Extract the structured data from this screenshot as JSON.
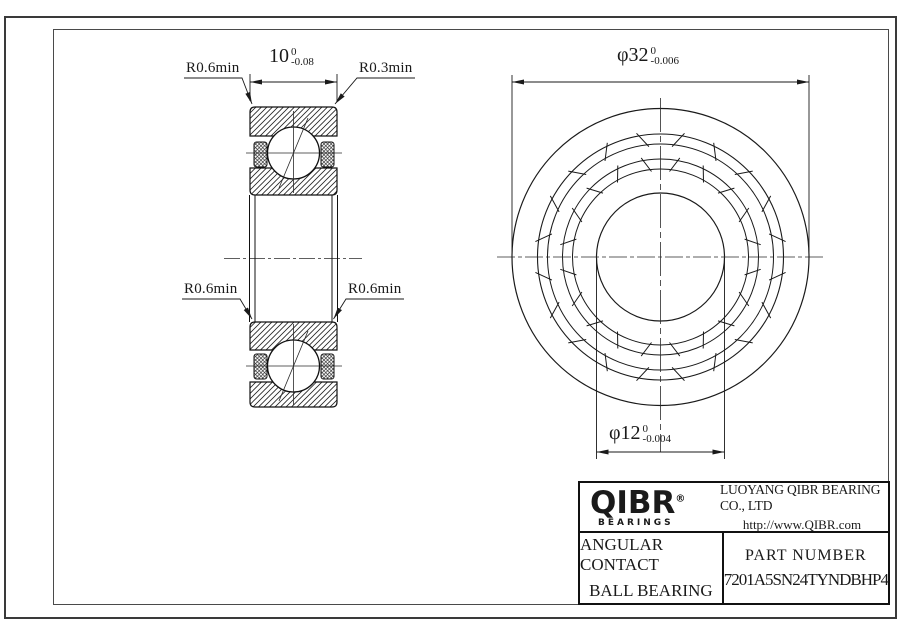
{
  "drawing": {
    "type": "bearing engineering drawing",
    "views": [
      "cross-section",
      "front"
    ]
  },
  "labels": {
    "radius_top_left": "R0.6min",
    "radius_top_right": "R0.3min",
    "radius_mid_left": "R0.6min",
    "radius_mid_right": "R0.6min"
  },
  "dimensions": {
    "width": {
      "value": "10",
      "tol_upper": "0",
      "tol_lower": "-0.08"
    },
    "outer_diameter": {
      "value": "φ32",
      "tol_upper": "0",
      "tol_lower": "-0.006"
    },
    "bore_diameter": {
      "value": "φ12",
      "tol_upper": "0",
      "tol_lower": "-0.004"
    }
  },
  "title_block": {
    "logo_text": "QIBR",
    "logo_registered": "®",
    "logo_subtext": "BEARINGS",
    "company_name": "LUOYANG QIBR BEARING CO., LTD",
    "website": "http://www.QIBR.com",
    "product_type_line1": "ANGULAR CONTACT",
    "product_type_line2": "BALL BEARING",
    "part_number_label": "PART NUMBER",
    "part_number": "7201A5SN24TYNDBHP4"
  },
  "colors": {
    "line": "#1a1a1a",
    "background": "#ffffff"
  }
}
